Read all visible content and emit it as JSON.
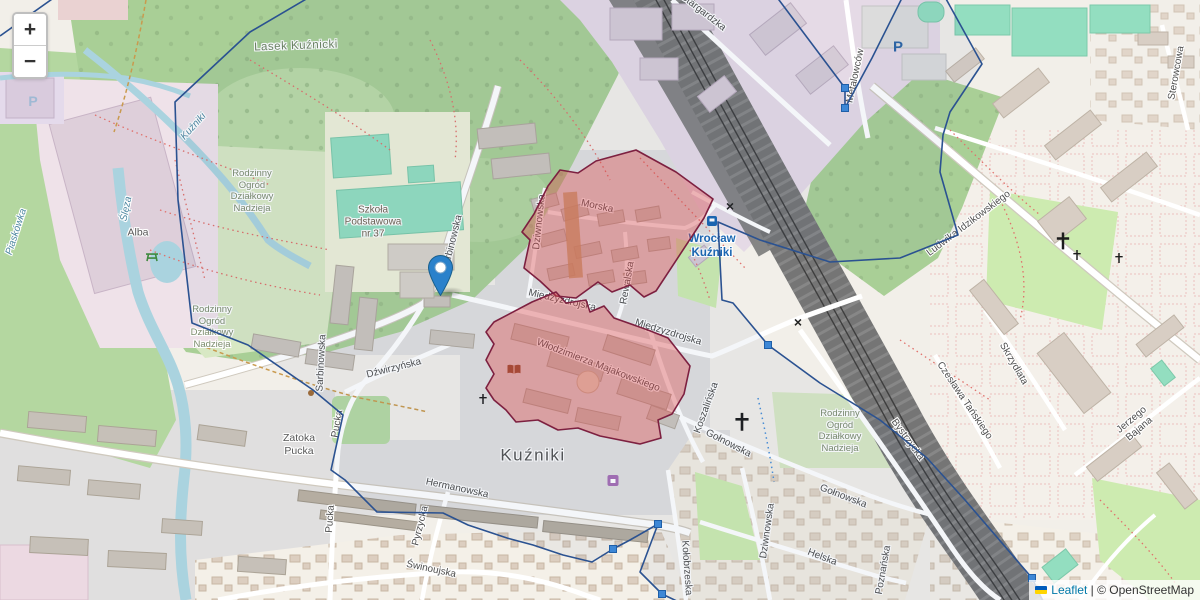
{
  "controls": {
    "zoom_in": "+",
    "zoom_out": "−"
  },
  "attribution": {
    "flag": "ukraine-flag",
    "leaflet": "Leaflet",
    "separator": " | ",
    "copyright": "© ",
    "osm": "OpenStreetMap"
  },
  "colors": {
    "boundary-stroke": "#2b5291",
    "boundary-fill": "rgba(43,82,145,0.05)",
    "area-fill": "rgba(224,72,72,0.38)",
    "area-stroke": "#7d2040",
    "vertex-fill": "#3d87d6",
    "marker-blue": "#2a81cb",
    "link-blue": "#0078a8",
    "station-blue": "#1b67b3"
  },
  "marker": {
    "x": 440,
    "y": 296
  },
  "overlays": {
    "boundary": {
      "points": [
        [
          175,
          102
        ],
        [
          250,
          32
        ],
        [
          325,
          -12
        ],
        [
          770,
          -12
        ],
        [
          845,
          88
        ],
        [
          845,
          108
        ],
        [
          872,
          58
        ],
        [
          906,
          -10
        ],
        [
          940,
          -12
        ],
        [
          982,
          64
        ],
        [
          950,
          112
        ],
        [
          943,
          135
        ],
        [
          940,
          172
        ],
        [
          958,
          235
        ],
        [
          900,
          258
        ],
        [
          830,
          262
        ],
        [
          760,
          240
        ],
        [
          718,
          222
        ],
        [
          722,
          300
        ],
        [
          733,
          303
        ],
        [
          768,
          345
        ],
        [
          820,
          383
        ],
        [
          880,
          420
        ],
        [
          927,
          458
        ],
        [
          965,
          500
        ],
        [
          1032,
          578
        ],
        [
          1048,
          612
        ],
        [
          700,
          612
        ],
        [
          662,
          594
        ],
        [
          640,
          572
        ],
        [
          658,
          524
        ],
        [
          630,
          540
        ],
        [
          613,
          549
        ],
        [
          592,
          562
        ],
        [
          563,
          555
        ],
        [
          533,
          545
        ],
        [
          507,
          538
        ],
        [
          468,
          525
        ],
        [
          443,
          513
        ],
        [
          377,
          512
        ],
        [
          345,
          480
        ],
        [
          331,
          470
        ],
        [
          343,
          415
        ],
        [
          313,
          390
        ],
        [
          248,
          345
        ],
        [
          192,
          323
        ],
        [
          178,
          200
        ]
      ],
      "extra_segment": [
        [
          62,
          -8
        ],
        [
          0,
          36
        ]
      ]
    },
    "red_areas": [
      {
        "name": "highlighted-area-morska",
        "points": [
          [
            548,
            186
          ],
          [
            560,
            170
          ],
          [
            578,
            173
          ],
          [
            596,
            161
          ],
          [
            636,
            150
          ],
          [
            676,
            172
          ],
          [
            713,
            199
          ],
          [
            704,
            218
          ],
          [
            656,
            291
          ],
          [
            644,
            297
          ],
          [
            630,
            285
          ],
          [
            612,
            292
          ],
          [
            598,
            282
          ],
          [
            576,
            298
          ],
          [
            556,
            296
          ],
          [
            540,
            281
          ],
          [
            524,
            268
          ],
          [
            530,
            240
          ],
          [
            522,
            232
          ],
          [
            534,
            214
          ]
        ]
      },
      {
        "name": "highlighted-area-majakowskiego",
        "points": [
          [
            494,
            322
          ],
          [
            532,
            302
          ],
          [
            556,
            292
          ],
          [
            566,
            303
          ],
          [
            586,
            300
          ],
          [
            590,
            312
          ],
          [
            604,
            306
          ],
          [
            614,
            318
          ],
          [
            648,
            330
          ],
          [
            668,
            338
          ],
          [
            690,
            366
          ],
          [
            684,
            394
          ],
          [
            672,
            414
          ],
          [
            658,
            420
          ],
          [
            661,
            438
          ],
          [
            640,
            444
          ],
          [
            600,
            436
          ],
          [
            578,
            428
          ],
          [
            558,
            430
          ],
          [
            538,
            420
          ],
          [
            516,
            422
          ],
          [
            506,
            410
          ],
          [
            494,
            400
          ],
          [
            486,
            388
          ],
          [
            494,
            374
          ],
          [
            486,
            360
          ],
          [
            494,
            344
          ],
          [
            486,
            332
          ]
        ]
      }
    ],
    "vertices": [
      [
        845,
        88
      ],
      [
        845,
        108
      ],
      [
        768,
        345
      ],
      [
        658,
        524
      ],
      [
        613,
        549
      ],
      [
        662,
        594
      ],
      [
        1032,
        578
      ]
    ]
  },
  "map_labels": [
    {
      "name": "lasek-kuznicki",
      "text": "Lasek Kuźnicki",
      "x": 296,
      "y": 46,
      "rot": -2,
      "cls": "forest"
    },
    {
      "name": "rod-nadzieja-1",
      "text": "Rodzinny\nOgród\nDziałkowy\nNadzieja",
      "x": 252,
      "y": 191,
      "rot": 0,
      "cls": "landuse"
    },
    {
      "name": "rod-nadzieja-2",
      "text": "Rodzinny\nOgród\nDziałkowy\nNadzieja",
      "x": 212,
      "y": 327,
      "rot": 0,
      "cls": "landuse"
    },
    {
      "name": "rod-nadzieja-3",
      "text": "Rodzinny\nOgród\nDziałkowy\nNadzieja",
      "x": 840,
      "y": 431,
      "rot": 0,
      "cls": "landuse"
    },
    {
      "name": "szkola-podstawowa",
      "text": "Szkoła\nPodstawowa\nnr 37",
      "x": 373,
      "y": 223,
      "rot": 0,
      "cls": "school"
    },
    {
      "name": "alba",
      "text": "Alba",
      "x": 138,
      "y": 233,
      "rot": 0,
      "cls": "place"
    },
    {
      "name": "zatoka-pucka",
      "text": "Zatoka\nPucka",
      "x": 299,
      "y": 445,
      "rot": 0,
      "cls": "place"
    },
    {
      "name": "kuzniki-district",
      "text": "Kuźniki",
      "x": 533,
      "y": 456,
      "rot": 0,
      "cls": "district"
    },
    {
      "name": "station-wroclaw-kuzniki",
      "text": "Wrocław\nKuźniki",
      "x": 712,
      "y": 246,
      "rot": 0,
      "cls": "station"
    },
    {
      "name": "morska",
      "text": "Morska",
      "x": 597,
      "y": 207,
      "rot": 12,
      "cls": "street"
    },
    {
      "name": "rewalska",
      "text": "Rewalska",
      "x": 628,
      "y": 283,
      "rot": -80,
      "cls": "street"
    },
    {
      "name": "dziwnowska-north",
      "text": "Dziwnowska",
      "x": 540,
      "y": 222,
      "rot": -84,
      "cls": "street"
    },
    {
      "name": "miedzyzdrojska-1",
      "text": "Międzyzdrojska",
      "x": 562,
      "y": 301,
      "rot": 13,
      "cls": "street"
    },
    {
      "name": "miedzyzdrojska-2",
      "text": "Międzyzdrojska",
      "x": 668,
      "y": 333,
      "rot": 17,
      "cls": "street"
    },
    {
      "name": "majakowskiego",
      "text": "Włodzimierza Majakowskiego",
      "x": 598,
      "y": 366,
      "rot": 21,
      "cls": "street"
    },
    {
      "name": "sarbinowska-1",
      "text": "Sarbinowska",
      "x": 453,
      "y": 243,
      "rot": -76,
      "cls": "street"
    },
    {
      "name": "sarbinowska-2",
      "text": "Sarbinowska",
      "x": 322,
      "y": 363,
      "rot": -87,
      "cls": "street"
    },
    {
      "name": "dzwirzynska",
      "text": "Dźwirzyńska",
      "x": 394,
      "y": 369,
      "rot": -14,
      "cls": "street"
    },
    {
      "name": "pucka-1",
      "text": "Pucka",
      "x": 338,
      "y": 424,
      "rot": -80,
      "cls": "street"
    },
    {
      "name": "pucka-2",
      "text": "Pucka",
      "x": 331,
      "y": 519,
      "rot": -86,
      "cls": "street"
    },
    {
      "name": "hermanowska",
      "text": "Hermanowska",
      "x": 457,
      "y": 489,
      "rot": 12,
      "cls": "street"
    },
    {
      "name": "pyrzycka",
      "text": "Pyrzycka",
      "x": 421,
      "y": 526,
      "rot": -76,
      "cls": "street"
    },
    {
      "name": "swinoujska",
      "text": "Świnoujska",
      "x": 431,
      "y": 570,
      "rot": 12,
      "cls": "street"
    },
    {
      "name": "kolobrzeska",
      "text": "Kołobrzeska",
      "x": 686,
      "y": 568,
      "rot": 86,
      "cls": "street"
    },
    {
      "name": "koszalinska",
      "text": "Koszalińska",
      "x": 707,
      "y": 408,
      "rot": -70,
      "cls": "street"
    },
    {
      "name": "golnowska-1",
      "text": "Gołnowska",
      "x": 728,
      "y": 444,
      "rot": 27,
      "cls": "street"
    },
    {
      "name": "golnowska-2",
      "text": "Gołnowska",
      "x": 843,
      "y": 497,
      "rot": 21,
      "cls": "street"
    },
    {
      "name": "helska",
      "text": "Helska",
      "x": 822,
      "y": 558,
      "rot": 21,
      "cls": "street"
    },
    {
      "name": "dziwnowska-south",
      "text": "Dziwnowska",
      "x": 768,
      "y": 531,
      "rot": -82,
      "cls": "street"
    },
    {
      "name": "poznanska",
      "text": "Poznańska",
      "x": 884,
      "y": 570,
      "rot": -80,
      "cls": "street"
    },
    {
      "name": "bystrzycka",
      "text": "Bystrzycka",
      "x": 907,
      "y": 440,
      "rot": 54,
      "cls": "street"
    },
    {
      "name": "metalowcow",
      "text": "Metalowców",
      "x": 856,
      "y": 76,
      "rot": -78,
      "cls": "street"
    },
    {
      "name": "sterowcowa",
      "text": "Sterowcowa",
      "x": 1177,
      "y": 73,
      "rot": -80,
      "cls": "street"
    },
    {
      "name": "idzikowskiego",
      "text": "Ludwika Idzikowskiego",
      "x": 969,
      "y": 224,
      "rot": -37,
      "cls": "street"
    },
    {
      "name": "skrzydlata",
      "text": "Skrzydlata",
      "x": 1013,
      "y": 364,
      "rot": 60,
      "cls": "street"
    },
    {
      "name": "tanskiego",
      "text": "Czesława Tańskiego",
      "x": 964,
      "y": 401,
      "rot": 56,
      "cls": "street"
    },
    {
      "name": "bajana",
      "text": "Jerzego Bajana",
      "x": 1136,
      "y": 425,
      "rot": -40,
      "cls": "street"
    },
    {
      "name": "stargardzka",
      "text": "Stargardzka",
      "x": 703,
      "y": 13,
      "rot": 38,
      "cls": "street"
    },
    {
      "name": "kuzniki-stream",
      "text": "Kuźniki",
      "x": 194,
      "y": 127,
      "rot": -48,
      "cls": "water"
    },
    {
      "name": "sleza-river",
      "text": "Ślęza",
      "x": 127,
      "y": 209,
      "rot": -78,
      "cls": "water"
    },
    {
      "name": "piaskowka",
      "text": "Piaskówka",
      "x": 17,
      "y": 232,
      "rot": -72,
      "cls": "water"
    }
  ],
  "map_icons": [
    {
      "name": "parking",
      "type": "text",
      "glyph": "P",
      "x": 898,
      "y": 47,
      "size": 15,
      "color": "#2e66a6"
    },
    {
      "name": "parking-2",
      "type": "text",
      "glyph": "P",
      "x": 33,
      "y": 101,
      "size": 14,
      "color": "#9fb9d4"
    },
    {
      "name": "church-cross-1",
      "type": "cross",
      "x": 1063,
      "y": 243,
      "size": 15
    },
    {
      "name": "church-cross-2",
      "type": "cross",
      "x": 1077,
      "y": 256,
      "size": 9
    },
    {
      "name": "church-cross-3",
      "type": "cross",
      "x": 1119,
      "y": 259,
      "size": 9
    },
    {
      "name": "church-cross-4",
      "type": "cross",
      "x": 742,
      "y": 424,
      "size": 16
    },
    {
      "name": "church-cross-5",
      "type": "cross",
      "x": 483,
      "y": 400,
      "size": 9
    },
    {
      "name": "picnic-table",
      "type": "picnic",
      "x": 152,
      "y": 258,
      "size": 14
    },
    {
      "name": "library-book",
      "type": "book",
      "x": 514,
      "y": 370,
      "size": 13
    },
    {
      "name": "shop",
      "type": "shop",
      "x": 613,
      "y": 482,
      "size": 11
    },
    {
      "name": "railway-station",
      "type": "rail",
      "x": 712,
      "y": 222,
      "size": 10
    },
    {
      "name": "level-crossing-1",
      "type": "text",
      "glyph": "×",
      "x": 730,
      "y": 206,
      "size": 14,
      "color": "#222"
    },
    {
      "name": "level-crossing-2",
      "type": "text",
      "glyph": "×",
      "x": 798,
      "y": 322,
      "size": 14,
      "color": "#222"
    },
    {
      "name": "poi-dot",
      "type": "dot",
      "x": 311,
      "y": 392,
      "size": 6
    }
  ]
}
